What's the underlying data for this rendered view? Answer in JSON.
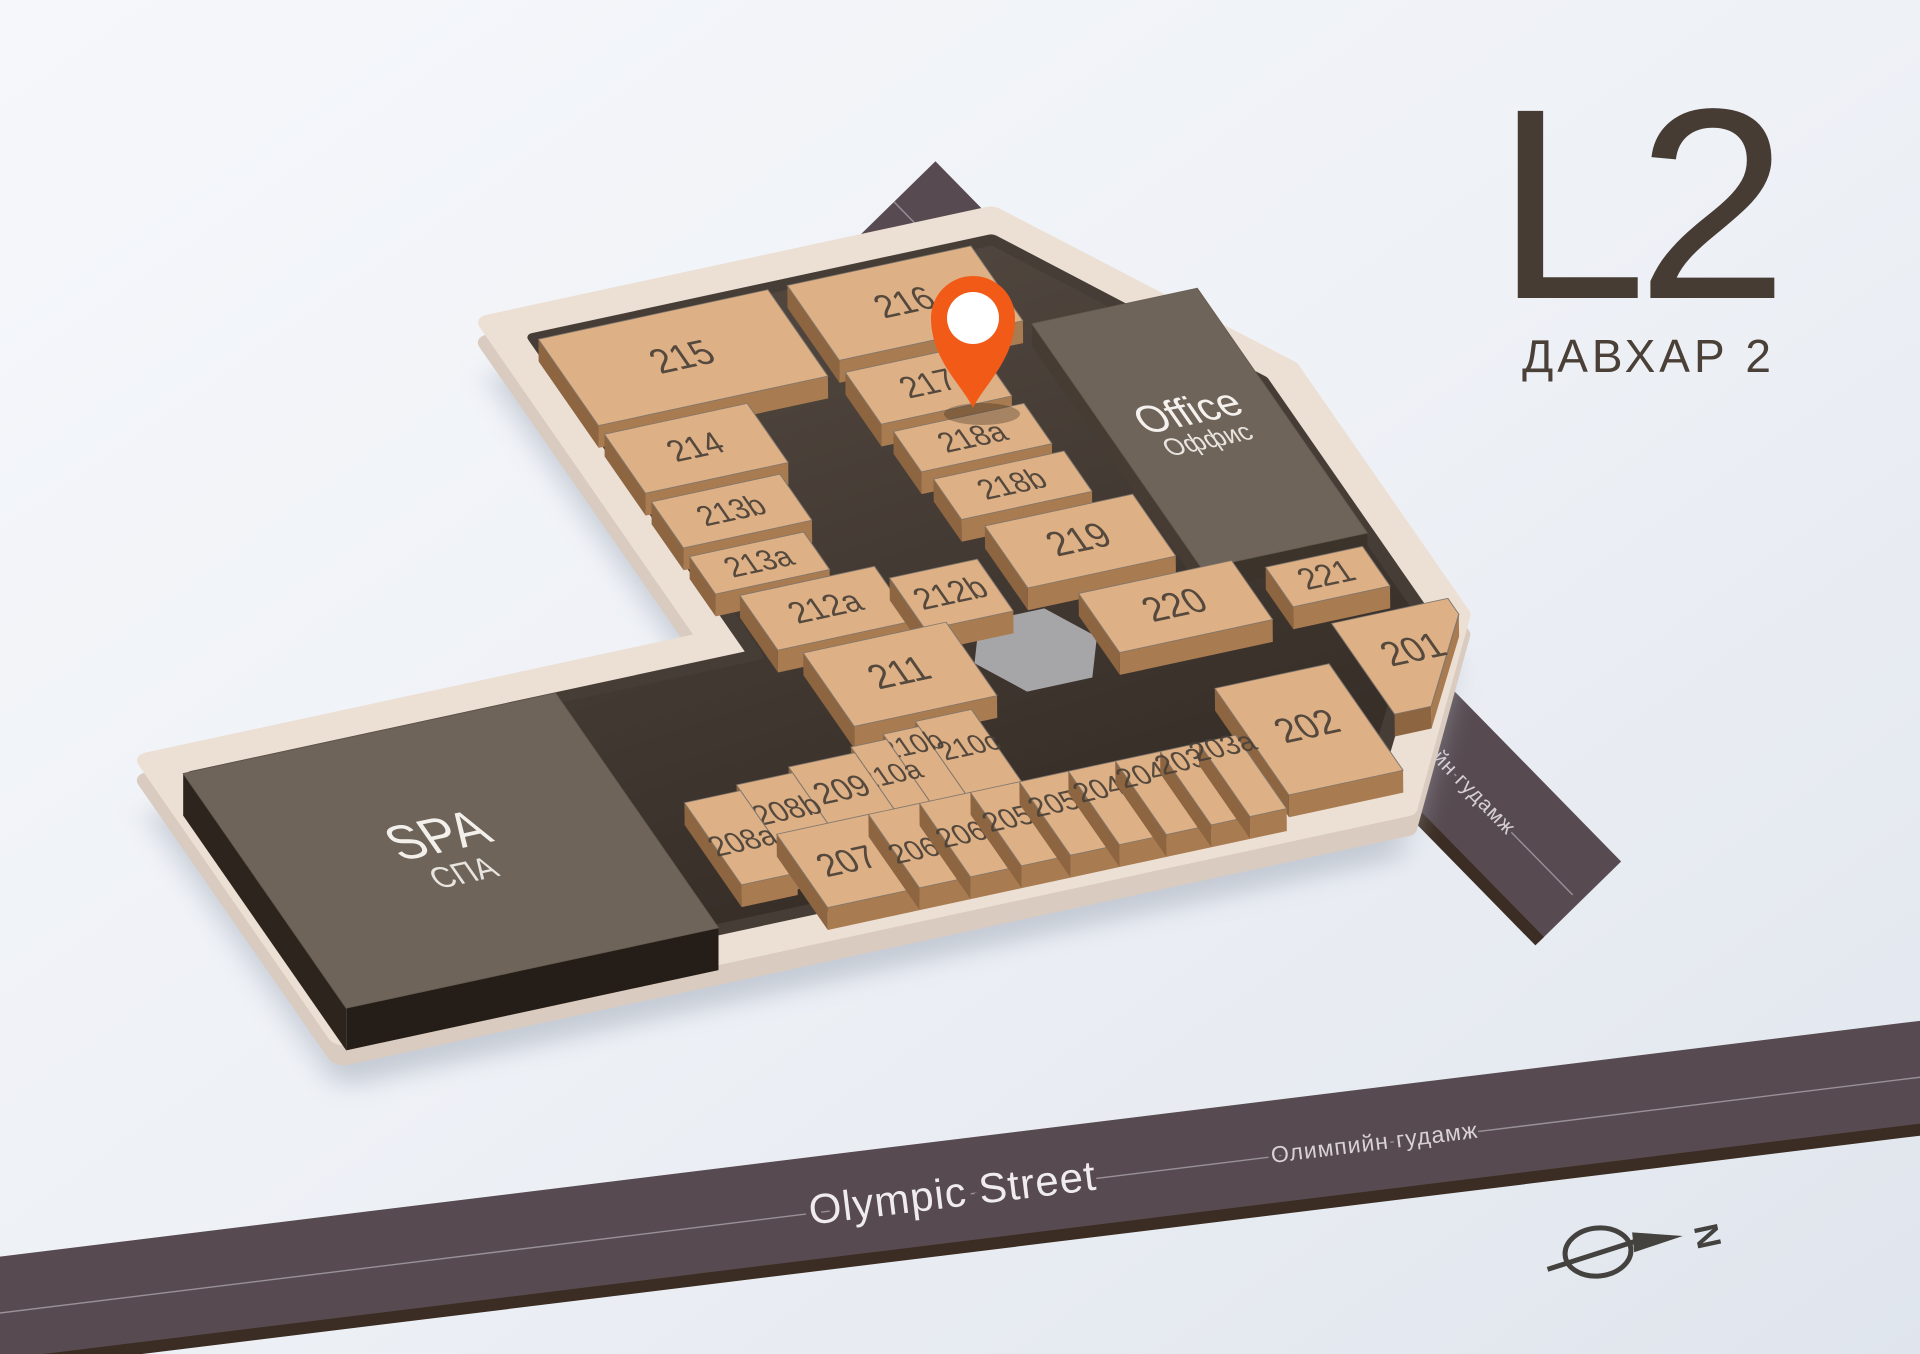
{
  "floor": {
    "code": "L2",
    "name_local": "ДАВХАР 2"
  },
  "streets": {
    "top": {
      "name": "Genden Street",
      "name_local": "Гэндэнгийн гудамж"
    },
    "bottom": {
      "name": "Olympic Street",
      "name_local": "Олимпийн гудамж"
    }
  },
  "areas": {
    "spa": {
      "name": "SPA",
      "name_local": "СПА"
    },
    "office": {
      "name": "Office",
      "name_local": "Оффис"
    }
  },
  "units": [
    {
      "id": "201",
      "label": "201"
    },
    {
      "id": "202",
      "label": "202"
    },
    {
      "id": "203a",
      "label": "203a"
    },
    {
      "id": "203b",
      "label": "203b"
    },
    {
      "id": "204a",
      "label": "204a"
    },
    {
      "id": "204b",
      "label": "204b"
    },
    {
      "id": "205a",
      "label": "205a"
    },
    {
      "id": "205b",
      "label": "205b"
    },
    {
      "id": "206a",
      "label": "206a"
    },
    {
      "id": "206b",
      "label": "206b"
    },
    {
      "id": "207",
      "label": "207"
    },
    {
      "id": "208a",
      "label": "208a"
    },
    {
      "id": "208b",
      "label": "208b"
    },
    {
      "id": "209",
      "label": "209"
    },
    {
      "id": "210a",
      "label": "210a"
    },
    {
      "id": "210b",
      "label": "210b"
    },
    {
      "id": "210c",
      "label": "210c"
    },
    {
      "id": "211",
      "label": "211"
    },
    {
      "id": "212a",
      "label": "212a"
    },
    {
      "id": "212b",
      "label": "212b"
    },
    {
      "id": "213a",
      "label": "213a"
    },
    {
      "id": "213b",
      "label": "213b"
    },
    {
      "id": "214",
      "label": "214"
    },
    {
      "id": "215",
      "label": "215"
    },
    {
      "id": "216",
      "label": "216"
    },
    {
      "id": "217",
      "label": "217"
    },
    {
      "id": "218a",
      "label": "218a"
    },
    {
      "id": "218b",
      "label": "218b"
    },
    {
      "id": "219",
      "label": "219"
    },
    {
      "id": "220",
      "label": "220"
    },
    {
      "id": "221",
      "label": "221"
    }
  ],
  "marker": {
    "type": "location-pin",
    "at_unit": "218a"
  },
  "compass": {
    "label": "N"
  },
  "colors": {
    "accent_pin": "#f15a17",
    "unit_roof": "#ddb086",
    "unit_front": "#a97b51",
    "unit_side": "#8d6540",
    "corridor": "#463d36",
    "plate": "#ecdfd3",
    "plate_side": "#d9cbbf",
    "dark_roof": "#6f6459",
    "street": "#574b51",
    "street_rim": "#3b2d23",
    "atrium": "#a6a5a7",
    "title": "#463c33",
    "label_text": "#4a4138"
  }
}
